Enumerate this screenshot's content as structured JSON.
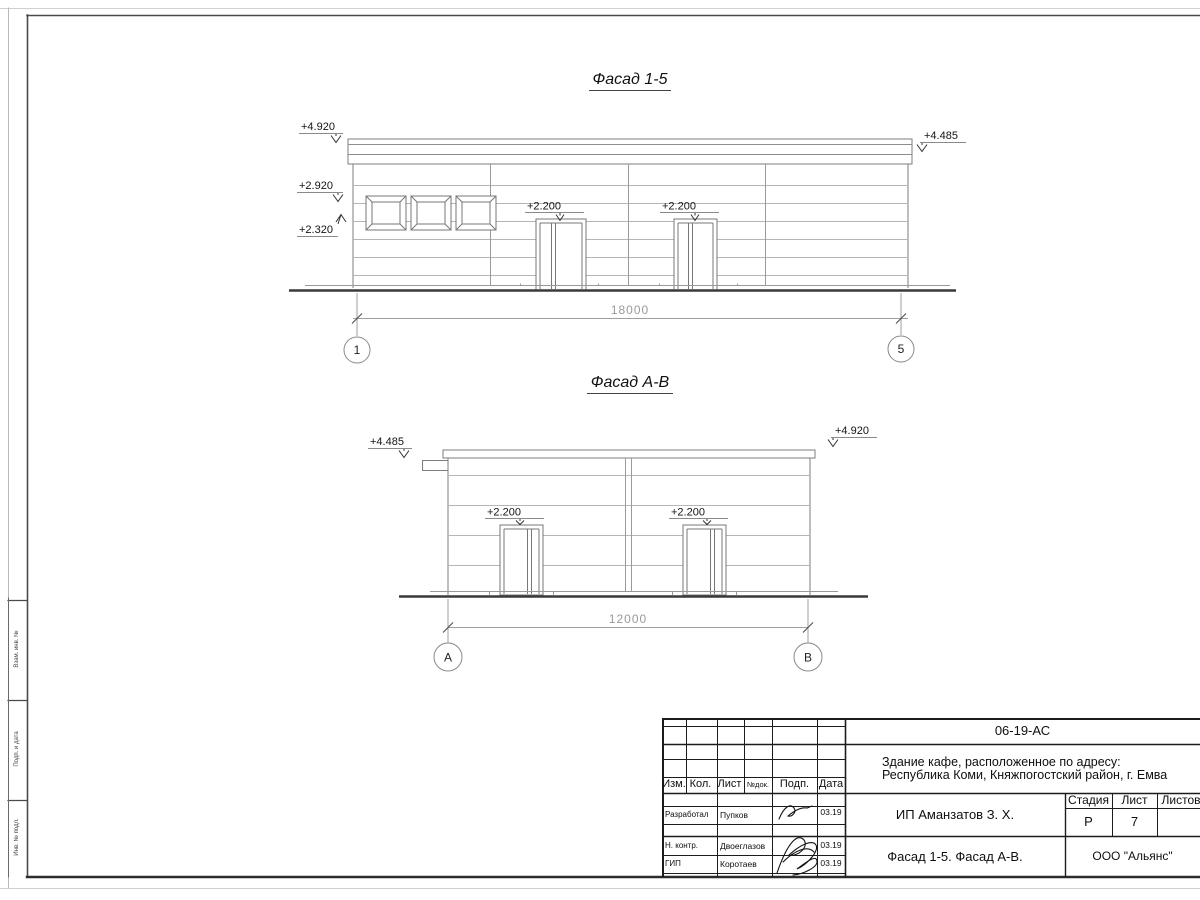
{
  "drawing": {
    "facade1": {
      "title": "Фасад 1-5",
      "mark_4920": "+4.920",
      "mark_2920": "+2.920",
      "mark_2320": "+2.320",
      "mark_4485": "+4.485",
      "door_mark_1": "+2.200",
      "door_mark_2": "+2.200",
      "dimension": "18000",
      "axis_left": "1",
      "axis_right": "5"
    },
    "facade2": {
      "title": "Фасад А-В",
      "mark_4485": "+4.485",
      "mark_4920": "+4.920",
      "door_mark_1": "+2.200",
      "door_mark_2": "+2.200",
      "dimension": "12000",
      "axis_left": "А",
      "axis_right": "В"
    }
  },
  "frame": {
    "side_labels": [
      "Взам. инв. №",
      "Подп. и дата",
      "Инв. № подл."
    ]
  },
  "titleblock": {
    "doc_number": "06-19-АС",
    "project_address_line1": "Здание кафе, расположенное по адресу:",
    "project_address_line2": "Республика Коми, Княжпогостский район, г. Емва",
    "columns": [
      "Изм.",
      "Кол.",
      "Лист",
      "№док.",
      "Подп.",
      "Дата"
    ],
    "staff": [
      {
        "role": "Разработал",
        "name": "Пупков",
        "date": "03.19"
      },
      {
        "role": "Н. контр.",
        "name": "Двоеглазов",
        "date": "03.19"
      },
      {
        "role": "ГИП",
        "name": "Коротаев",
        "date": "03.19"
      }
    ],
    "client": "ИП Аманзатов З. Х.",
    "stage_label": "Стадия",
    "sheet_label": "Лист",
    "sheets_label": "Листов",
    "stage_value": "Р",
    "sheet_value": "7",
    "sheet_title": "Фасад 1-5. Фасад А-В.",
    "company": "ООО \"Альянс\""
  },
  "colors": {
    "line_dark": "#3a3a3a",
    "line_medium": "#7d7d7d",
    "line_light": "#b5b5b5",
    "dim_text": "#9a9a9a"
  }
}
